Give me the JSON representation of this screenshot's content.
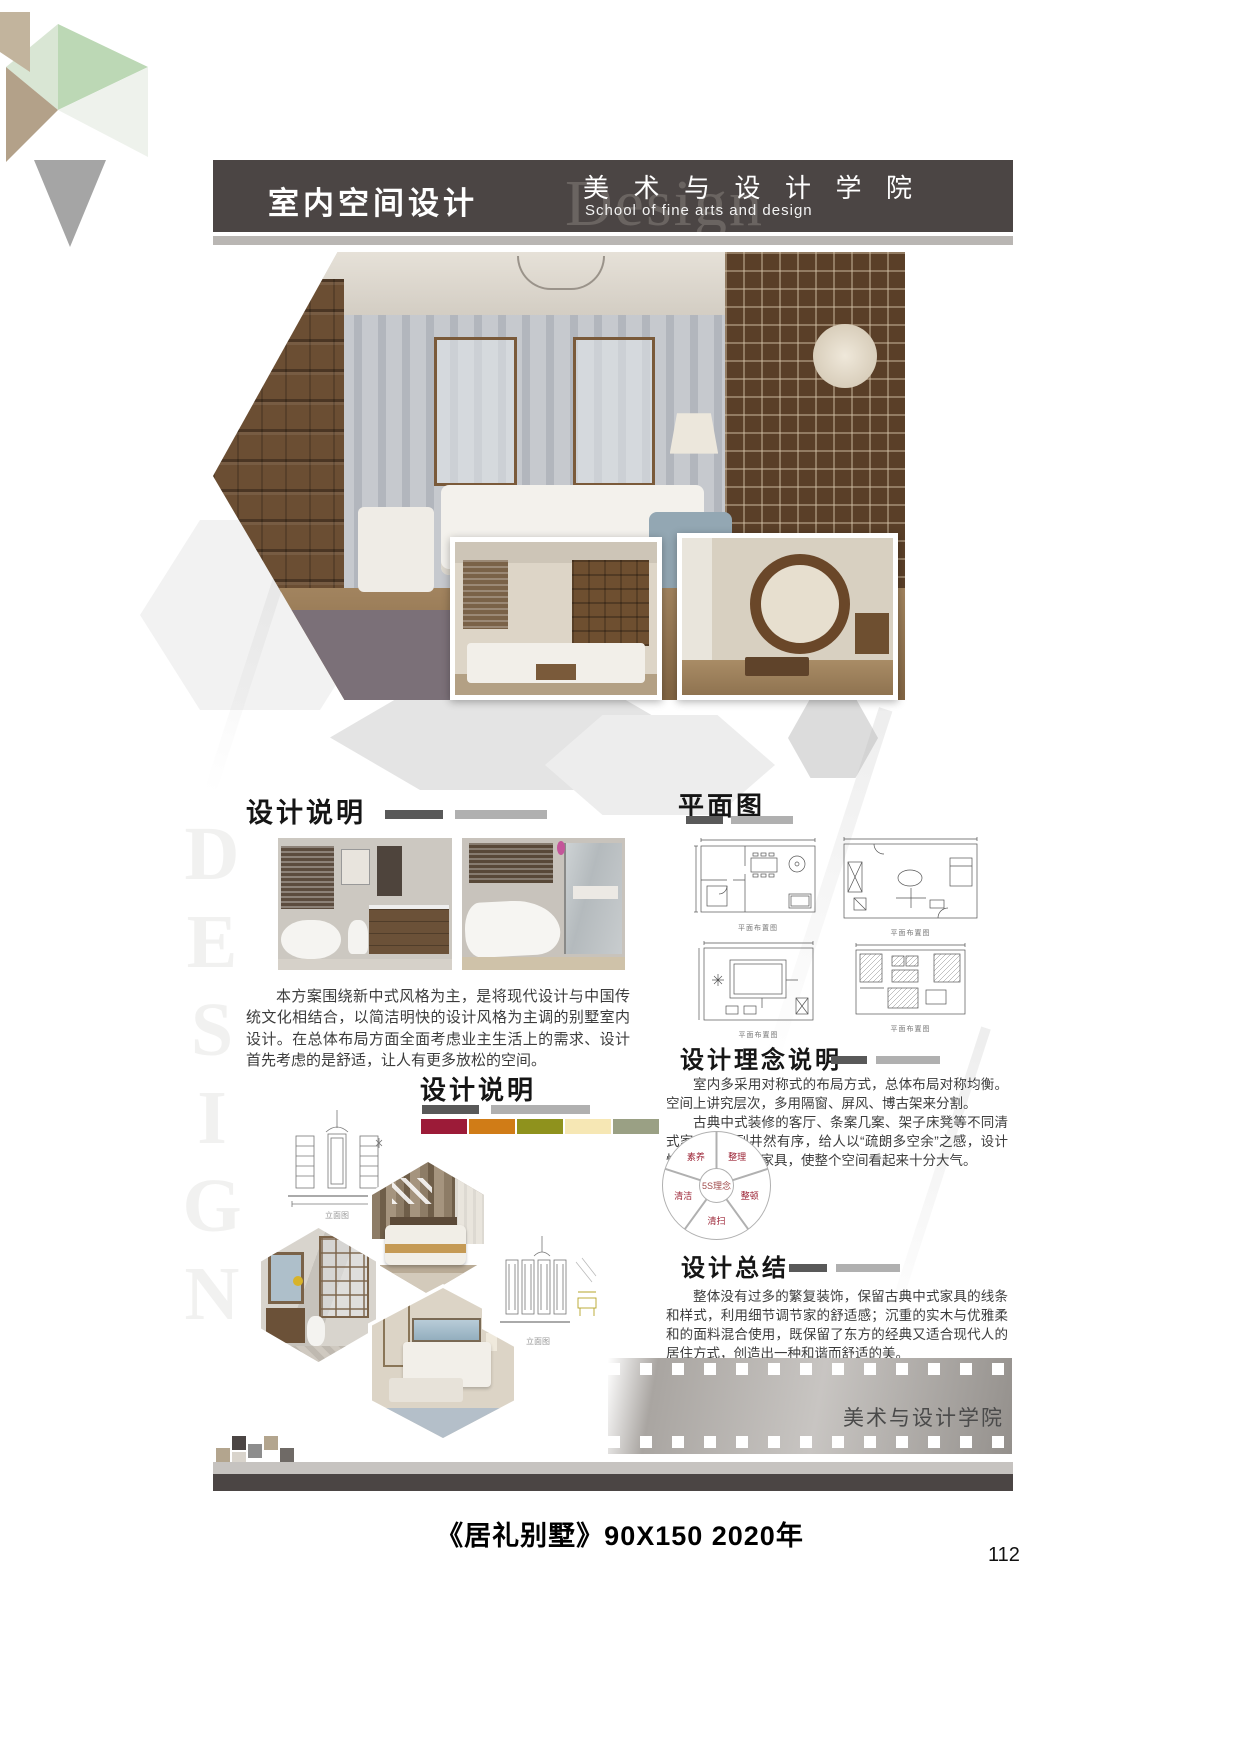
{
  "banner": {
    "title": "室内空间设计",
    "school_cn": "美 术 与 设 计 学 院",
    "school_en": "School of fine arts and design",
    "watermark": "Design",
    "bg_color": "#4b4544"
  },
  "side_watermark": "DESIGN",
  "design_note": {
    "heading": "设计说明",
    "body": "本方案围绕新中式风格为主，是将现代设计与中国传统文化相结合，以简洁明快的设计风格为主调的别墅室内设计。在总体布局方面全面考虑业主生活上的需求、设计首先考虑的是舒适，让人有更多放松的空间。"
  },
  "design_note2": {
    "heading": "设计说明",
    "palette": [
      "#9c1b38",
      "#d07c17",
      "#8f921d",
      "#f6e7b4",
      "#9aa084"
    ],
    "elevation_caption_a": "立面图",
    "elevation_caption_b": "立面图"
  },
  "floor_plan": {
    "heading": "平面图",
    "captions": [
      "平面布置图",
      "平面布置图",
      "平面布置图",
      "平面布置图"
    ]
  },
  "concept": {
    "heading": "设计理念说明",
    "p1": "室内多采用对称式的布局方式，总体布局对称均衡。空间上讲究层次，多用隔窗、屏风、博古架来分割。",
    "p2": "古典中式装修的客厅、条案几案、架子床凳等不同清式家具的排列井然有序，给人以“疏朗多空余”之感，设计恰到好处的原木家具，使整个空间看起来十分大气。"
  },
  "wheel": {
    "center": "5S理念",
    "labels": [
      "整理",
      "整顿",
      "清扫",
      "清洁",
      "素养"
    ]
  },
  "summary": {
    "heading": "设计总结",
    "body": "整体没有过多的繁复装饰，保留古典中式家具的线条和样式，利用细节调节家的舒适感；沉重的实木与优雅柔和的面料混合使用，既保留了东方的经典又适合现代人的居住方式，创造出一种和谐而舒适的美。"
  },
  "footer": {
    "school": "美术与设计学院"
  },
  "artwork": {
    "caption": "《居礼别墅》90X150 2020年"
  },
  "page_number": "112"
}
